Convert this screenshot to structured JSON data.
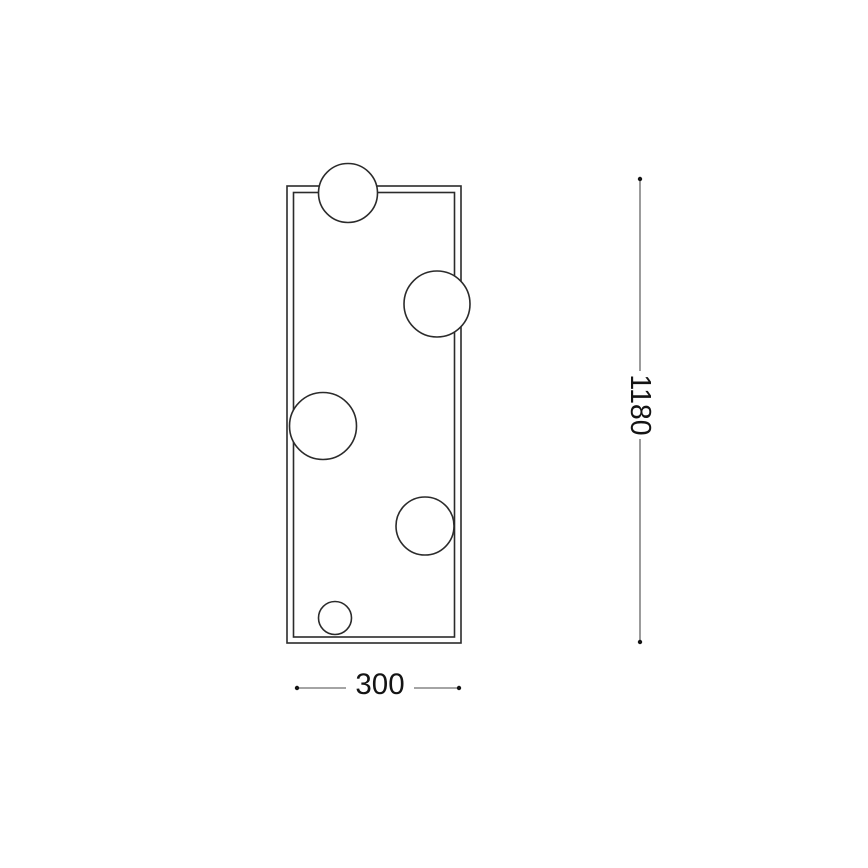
{
  "page": {
    "background_color": "#ffffff",
    "description": "Technical dimension drawing of a rectangular wall light fixture with five sphere lamps"
  },
  "drawing": {
    "line_color": "#2b2b2b",
    "dim_line_color": "#4a4a4a",
    "text_color": "#141414",
    "frame": {
      "outer": {
        "x": 287,
        "y": 186,
        "width": 174,
        "height": 457
      },
      "inner": {
        "x": 293.5,
        "y": 192.5,
        "width": 161,
        "height": 444.5
      }
    },
    "spheres": [
      {
        "cx": 348,
        "cy": 193,
        "r": 29.5
      },
      {
        "cx": 437,
        "cy": 304,
        "r": 33
      },
      {
        "cx": 323,
        "cy": 426,
        "r": 33.5
      },
      {
        "cx": 425,
        "cy": 526,
        "r": 29
      },
      {
        "cx": 335,
        "cy": 618,
        "r": 16.5
      }
    ],
    "dimensions": {
      "height": {
        "label": "1180",
        "orientation": "vertical",
        "x": 640,
        "start": 179,
        "end": 642,
        "text_cx": 640,
        "text_cy": 405,
        "gap_start": 371,
        "gap_end": 439,
        "font_size": 28.5
      },
      "width": {
        "label": "300",
        "orientation": "horizontal",
        "y": 688,
        "start": 297,
        "end": 459,
        "text_cx": 380,
        "text_cy": 684.5,
        "gap_start": 346,
        "gap_end": 414,
        "font_size": 29.5
      }
    },
    "dot_radius": 2.2
  }
}
